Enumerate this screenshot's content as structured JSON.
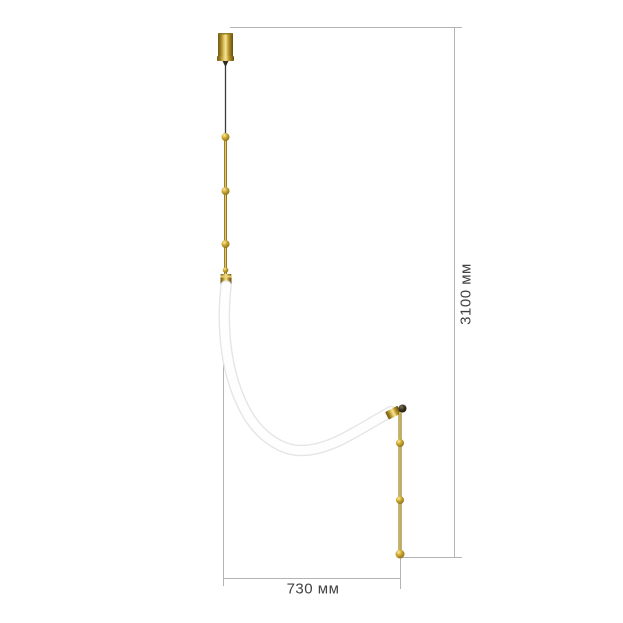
{
  "page": {
    "background": "#ffffff",
    "description": "Dimensional drawing of a curved-tube pendant light with brass stems"
  },
  "dimensions": {
    "height": {
      "label": "3100 мм",
      "value_mm": 3100
    },
    "width": {
      "label": "730 мм",
      "value_mm": 730
    }
  },
  "fixture_parts": [
    "ceiling canopy",
    "suspension cable",
    "upper stem with spheres",
    "flexible white tube",
    "lower stem with spheres"
  ],
  "style": {
    "dimension_line_color": "#b3b3b3",
    "label_text_color": "#424242",
    "brass_highlight": "#f2e39c",
    "brass_mid": "#c9a227",
    "brass_dark": "#70591a",
    "cable_color": "#3b3b3b",
    "tube_fill": "#fefefe",
    "tube_edge": "#e5e5e5"
  }
}
